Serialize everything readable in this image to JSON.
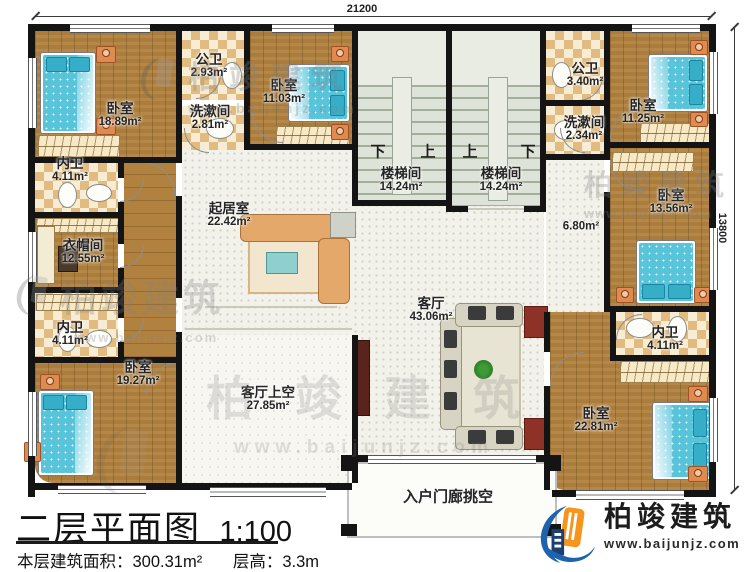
{
  "dimensions": {
    "top": "21200",
    "right": "13800"
  },
  "rooms": {
    "bedroom_tl": {
      "name": "卧室",
      "area": "18.89m²"
    },
    "pubbath_tl": {
      "name": "公卫",
      "area": "2.93m²"
    },
    "wash_l": {
      "name": "洗漱间",
      "area": "2.81m²"
    },
    "bedroom_tm": {
      "name": "卧室",
      "area": "11.03m²"
    },
    "innerbath_l1": {
      "name": "内卫",
      "area": "4.11m²"
    },
    "cloak": {
      "name": "衣帽间",
      "area": "12.55m²"
    },
    "innerbath_l2": {
      "name": "内卫",
      "area": "4.11m²"
    },
    "bedroom_bl": {
      "name": "卧室",
      "area": "19.27m²"
    },
    "sitting": {
      "name": "起居室",
      "area": "22.42m²"
    },
    "stair_l": {
      "name": "楼梯间",
      "area": "14.24m²"
    },
    "stair_r": {
      "name": "楼梯间",
      "area": "14.24m²"
    },
    "pubbath_tr": {
      "name": "公卫",
      "area": "3.40m²"
    },
    "wash_r": {
      "name": "洗漱间",
      "area": "2.34m²"
    },
    "bedroom_tr": {
      "name": "卧室",
      "area": "11.25m²"
    },
    "bedroom_rm": {
      "name": "卧室",
      "area": "13.56m²"
    },
    "hall": {
      "area": "6.80m²"
    },
    "living": {
      "name": "客厅",
      "area": "43.06m²"
    },
    "living_void": {
      "name": "客厅上空",
      "area": "27.85m²"
    },
    "innerbath_r": {
      "name": "内卫",
      "area": "4.11m²"
    },
    "bedroom_br": {
      "name": "卧室",
      "area": "22.81m²"
    },
    "porch": {
      "name": "入户门廊挑空"
    }
  },
  "stairs": {
    "left_down": "下",
    "left_up": "上",
    "right_up": "上",
    "right_down": "下"
  },
  "title_block": {
    "plan_name": "二层平面图",
    "scale": "1:100",
    "area_line": "本层建筑面积：300.31m²",
    "floor_height": "层高：3.3m"
  },
  "brand": {
    "name": "柏竣建筑",
    "url": "www.baijunjz.com"
  },
  "watermark": {
    "text": "柏竣建筑",
    "url": "www.baijunjz.com"
  },
  "colors": {
    "wall": "#141414",
    "wood": "#b1823f",
    "bed": "#58c4da",
    "logo_blue": "#1e63ad",
    "logo_orange": "#f6951e"
  }
}
